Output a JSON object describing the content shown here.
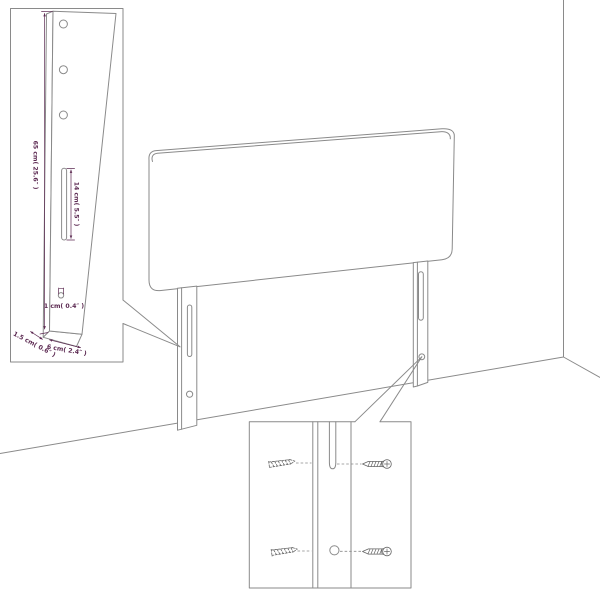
{
  "page": {
    "title": "Headboard assembly diagram",
    "background": "#ffffff"
  },
  "colors": {
    "line": "#8a8a8a",
    "dimension": "#5c2a52",
    "screw": "#666666"
  },
  "detail_left": {
    "labels": {
      "height": "65 cm( 25.6″ )",
      "slot_length": "14 cm( 5.5″ )",
      "hole": "1 cm( 0.4″ )",
      "thickness": "1.5 cm( 0.6″ )",
      "width": "6 cm( 2.4″ )"
    }
  },
  "icons": {
    "screw_solid": "screw-icon",
    "screw_dashed": "screw-dashed-icon",
    "slot": "mounting-slot",
    "hole": "mounting-hole"
  }
}
